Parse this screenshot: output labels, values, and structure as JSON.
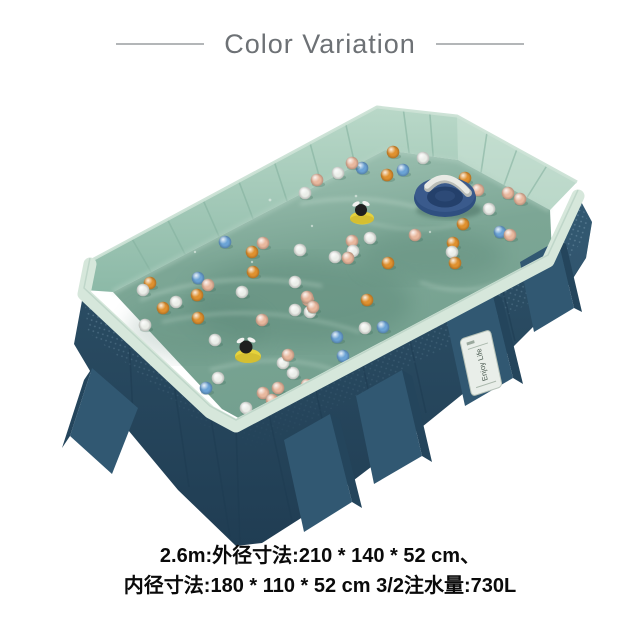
{
  "header": {
    "title": "Color Variation"
  },
  "specs": {
    "line1": "2.6m:外径寸法:210 * 140 * 52 cm、",
    "line2": "内径寸法:180 * 110 * 52 cm 3/2注水量:730L"
  },
  "pool": {
    "label_text": "Enjoy Life",
    "ball_colors": {
      "white": "#ebeee9",
      "orange": "#e0912f",
      "peach": "#e9b89e",
      "blue": "#6ba3d6"
    },
    "balls": [
      [
        393,
        152,
        "orange"
      ],
      [
        423,
        158,
        "white"
      ],
      [
        362,
        168,
        "blue"
      ],
      [
        403,
        170,
        "blue"
      ],
      [
        387,
        175,
        "orange"
      ],
      [
        352,
        163,
        "peach"
      ],
      [
        338,
        173,
        "white"
      ],
      [
        317,
        180,
        "peach"
      ],
      [
        305,
        193,
        "white"
      ],
      [
        465,
        178,
        "orange"
      ],
      [
        478,
        190,
        "peach"
      ],
      [
        508,
        193,
        "peach"
      ],
      [
        520,
        199,
        "peach"
      ],
      [
        489,
        209,
        "white"
      ],
      [
        463,
        224,
        "orange"
      ],
      [
        453,
        243,
        "orange"
      ],
      [
        452,
        252,
        "white"
      ],
      [
        500,
        232,
        "blue"
      ],
      [
        510,
        235,
        "peach"
      ],
      [
        455,
        263,
        "orange"
      ],
      [
        415,
        235,
        "peach"
      ],
      [
        370,
        238,
        "white"
      ],
      [
        352,
        241,
        "peach"
      ],
      [
        353,
        251,
        "white"
      ],
      [
        348,
        258,
        "peach"
      ],
      [
        335,
        257,
        "white"
      ],
      [
        388,
        263,
        "orange"
      ],
      [
        367,
        300,
        "orange"
      ],
      [
        295,
        282,
        "white"
      ],
      [
        308,
        300,
        "peach"
      ],
      [
        310,
        312,
        "white"
      ],
      [
        295,
        310,
        "white"
      ],
      [
        337,
        337,
        "blue"
      ],
      [
        365,
        328,
        "white"
      ],
      [
        383,
        327,
        "blue"
      ],
      [
        343,
        356,
        "blue"
      ],
      [
        293,
        373,
        "white"
      ],
      [
        307,
        385,
        "peach"
      ],
      [
        225,
        242,
        "blue"
      ],
      [
        263,
        243,
        "peach"
      ],
      [
        252,
        252,
        "orange"
      ],
      [
        300,
        250,
        "white"
      ],
      [
        253,
        272,
        "orange"
      ],
      [
        198,
        278,
        "blue"
      ],
      [
        150,
        283,
        "orange"
      ],
      [
        143,
        290,
        "white"
      ],
      [
        208,
        285,
        "peach"
      ],
      [
        197,
        295,
        "orange"
      ],
      [
        242,
        292,
        "white"
      ],
      [
        307,
        297,
        "peach"
      ],
      [
        313,
        307,
        "peach"
      ],
      [
        198,
        318,
        "orange"
      ],
      [
        145,
        325,
        "white"
      ],
      [
        262,
        320,
        "peach"
      ],
      [
        215,
        340,
        "white"
      ],
      [
        283,
        363,
        "white"
      ],
      [
        288,
        355,
        "peach"
      ],
      [
        163,
        308,
        "orange"
      ],
      [
        176,
        302,
        "white"
      ],
      [
        218,
        378,
        "white"
      ],
      [
        206,
        388,
        "blue"
      ],
      [
        263,
        393,
        "peach"
      ],
      [
        278,
        388,
        "peach"
      ],
      [
        246,
        408,
        "white"
      ],
      [
        272,
        400,
        "peach"
      ]
    ]
  },
  "colors": {
    "title-gray": "#6d7175",
    "spec-black": "#0a0a0a",
    "navy-wall": "#2d5068",
    "navy-dark": "#24455c",
    "navy-leg": "#315872",
    "mint-wall": "#a3c9b7",
    "mint-rim": "#d6e7db",
    "water-light": "#9cc0b0",
    "water-deep": "#5d8a7a",
    "ring-navy": "#2f4f80",
    "float-yellow": "#e6d23c"
  }
}
